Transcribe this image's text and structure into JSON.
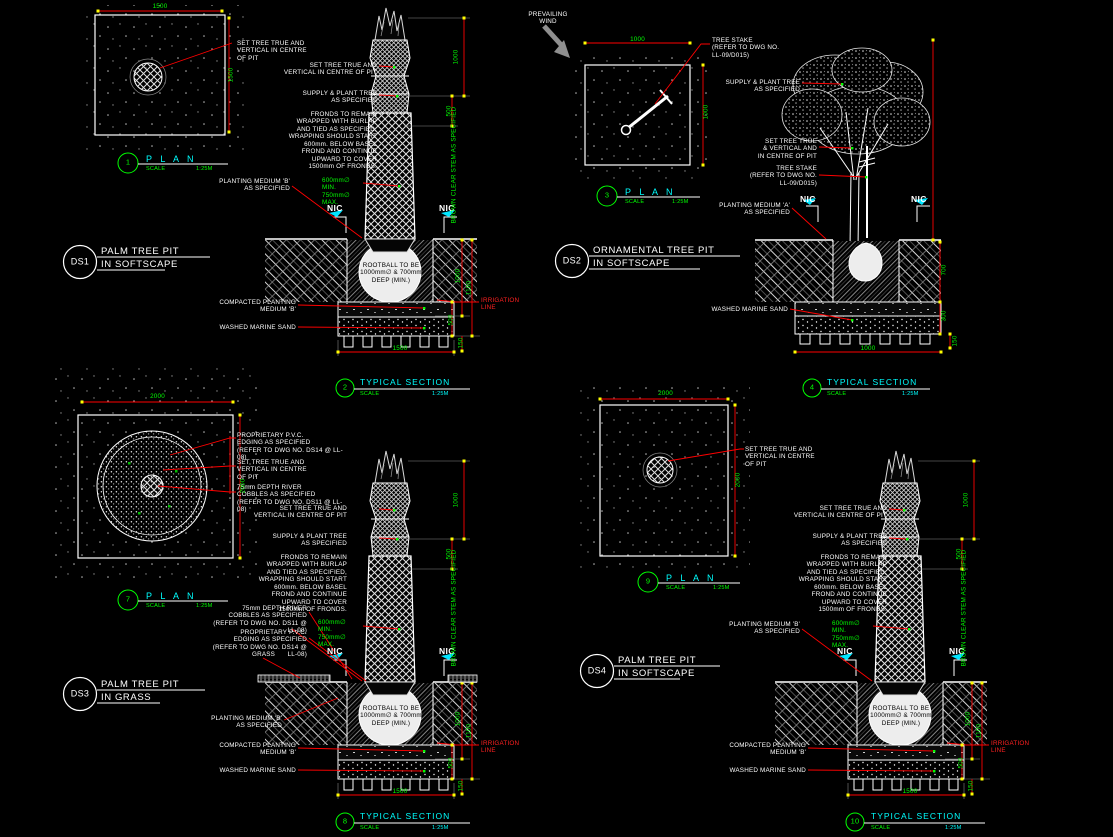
{
  "sheet": {
    "background": "#000000"
  },
  "colors": {
    "line": "#ffffff",
    "leader": "#ff0000",
    "dimension_text": "#00ff00",
    "heading": "#00ffff",
    "bubble": "#00ff00",
    "nic_marker": "#00e5ff",
    "tick": "#ffff00",
    "wind_arrow": "#8f8f8f"
  },
  "common": {
    "set_tree_plan": "SET TREE TRUE AND\nVERTICAL IN CENTRE\nOF PIT",
    "set_tree_section": "SET TREE TRUE AND\nVERTICAL IN CENTRE OF PIT",
    "set_tree_ornamental": "SET TREE TRUE\n& VERTICAL AND\nIN CENTRE OF PIT",
    "supply": "SUPPLY & PLANT TREE\nAS SPECIFIED",
    "fronds": "FRONDS TO REMAIN\nWRAPPED WITH BURLAP\nAND TIED AS SPECIFIED,\nWRAPPING SHOULD START\n600mm. BELOW BASEL\nFROND AND CONTINUE\nUPWARD TO COVER\n1500mm OF FRONDS.",
    "medium_a": "PLANTING MEDIUM 'A'\nAS SPECIFIED",
    "medium_b": "PLANTING MEDIUM 'B'\nAS SPECIFIED",
    "rootball_dia": "600mm∅ MIN.\n750mm∅ MAX.",
    "nic": "NIC",
    "rootball": "ROOTBALL TO BE\n1000mm∅ & 700mm\nDEEP (MIN.)",
    "compacted": "COMPACTED PLANTING\nMEDIUM 'B'",
    "washed": "WASHED MARINE SAND",
    "irrigation": "IRRIGATION\nLINE",
    "stem": "BROWN CLEAR STEM AS SPECIFIED",
    "grass": "GRASS",
    "pvc": "PROPRIETARY P.V.C.\nEDGING AS SPECIFIED\n(REFER TO DWG NO. DS14 @ LL-08)",
    "cobbles": "75mm DEPTH RIVER\nCOBBLES AS SPECIFIED\n(REFER TO DWG NO. DS11 @ LL-08)",
    "tree_stake": "TREE STAKE\n(REFER TO DWG NO.\nLL-09/D015)",
    "wind": "PREVAILING\nWIND",
    "plan_word": "P L A N",
    "section_word": "TYPICAL SECTION",
    "scale_word": "SCALE",
    "scale_value": "1:25M",
    "pd1": "1000",
    "pd2": "500",
    "pd3": "1000",
    "pd4": "1100",
    "pd5": "500",
    "pd6": "150"
  },
  "ds1": {
    "id": "DS1",
    "t1": "PALM TREE PIT",
    "t2": "IN SOFTSCAPE",
    "plan_no": "1",
    "sec_no": "2",
    "plan_w": "1500",
    "plan_h": "1500",
    "sec_w": "1500"
  },
  "ds2": {
    "id": "DS2",
    "t1": "ORNAMENTAL TREE PIT",
    "t2": "IN SOFTSCAPE",
    "plan_no": "3",
    "sec_no": "4",
    "plan_w": "1000",
    "plan_h": "1000",
    "sec_w": "1000",
    "dim_depth": "700",
    "dim_base": "300",
    "dim_sub": "150"
  },
  "ds3": {
    "id": "DS3",
    "t1": "PALM TREE PIT",
    "t2": "IN GRASS",
    "plan_no": "7",
    "sec_no": "8",
    "plan_w": "2000",
    "plan_h": "2000",
    "sec_w": "1500"
  },
  "ds4": {
    "id": "DS4",
    "t1": "PALM TREE PIT",
    "t2": "IN SOFTSCAPE",
    "plan_no": "9",
    "sec_no": "10",
    "plan_w": "2000",
    "plan_h": "2000",
    "sec_w": "1500"
  }
}
